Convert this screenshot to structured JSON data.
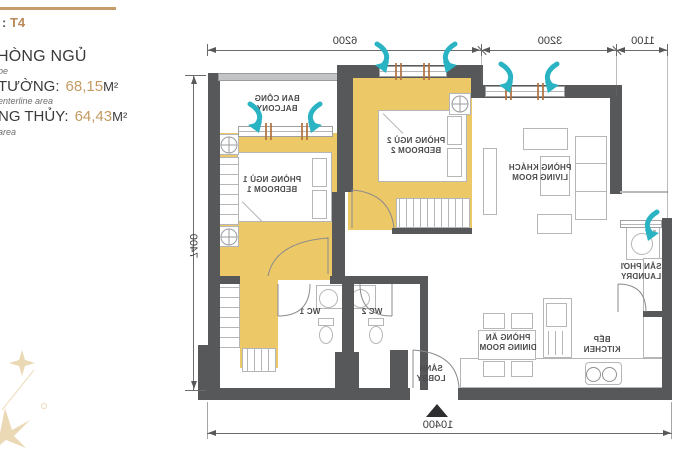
{
  "info_panel": {
    "unit_prefix": ":",
    "unit_code": "T4",
    "heading_fragment": "HÒNG NGỦ",
    "heading_note_fragment": "oe",
    "area_rows": [
      {
        "label": "TƯỜNG:",
        "value": "68,15",
        "unit": "M²",
        "note": "enterline area"
      },
      {
        "label": "NG THỦY:",
        "value": "64,43",
        "unit": "M²",
        "note": "area"
      }
    ]
  },
  "floor_plan": {
    "mirrored": true,
    "dimensions": {
      "top": [
        "6200",
        "3200",
        "1100"
      ],
      "side": "7400",
      "bottom": "10400"
    },
    "rooms": {
      "balcony": {
        "vi": "BAN CÔNG",
        "en": "BALCONY"
      },
      "bedroom1": {
        "vi": "PHÒNG NGỦ 1",
        "en": "BEDROOM 1"
      },
      "bedroom2": {
        "vi": "PHÒNG NGỦ 2",
        "en": "BEDROOM 2"
      },
      "living": {
        "vi": "PHÒNG KHÁCH",
        "en": "LIVING ROOM"
      },
      "laundry": {
        "vi": "SÂN PHƠI",
        "en": "LAUNDRY"
      },
      "wc1": {
        "vi": "WC 1"
      },
      "wc2": {
        "vi": "WC 2"
      },
      "dining": {
        "vi": "PHÒNG ĂN",
        "en": "DINING ROOM"
      },
      "kitchen": {
        "vi": "BẾP",
        "en": "KITCHEN"
      },
      "lobby": {
        "vi": "SẢNH",
        "en": "LOBBY"
      }
    }
  },
  "colors": {
    "highlight_yellow": "#edc867",
    "wall_dark": "#57585a",
    "wall_light": "#c3c4c6",
    "airflow_cyan": "#2ab3c3",
    "accent_gold": "#c69c6d",
    "value_gold": "#c49a62",
    "text_dark": "#3a3a3c",
    "window_tick_brown": "#b0713d"
  }
}
